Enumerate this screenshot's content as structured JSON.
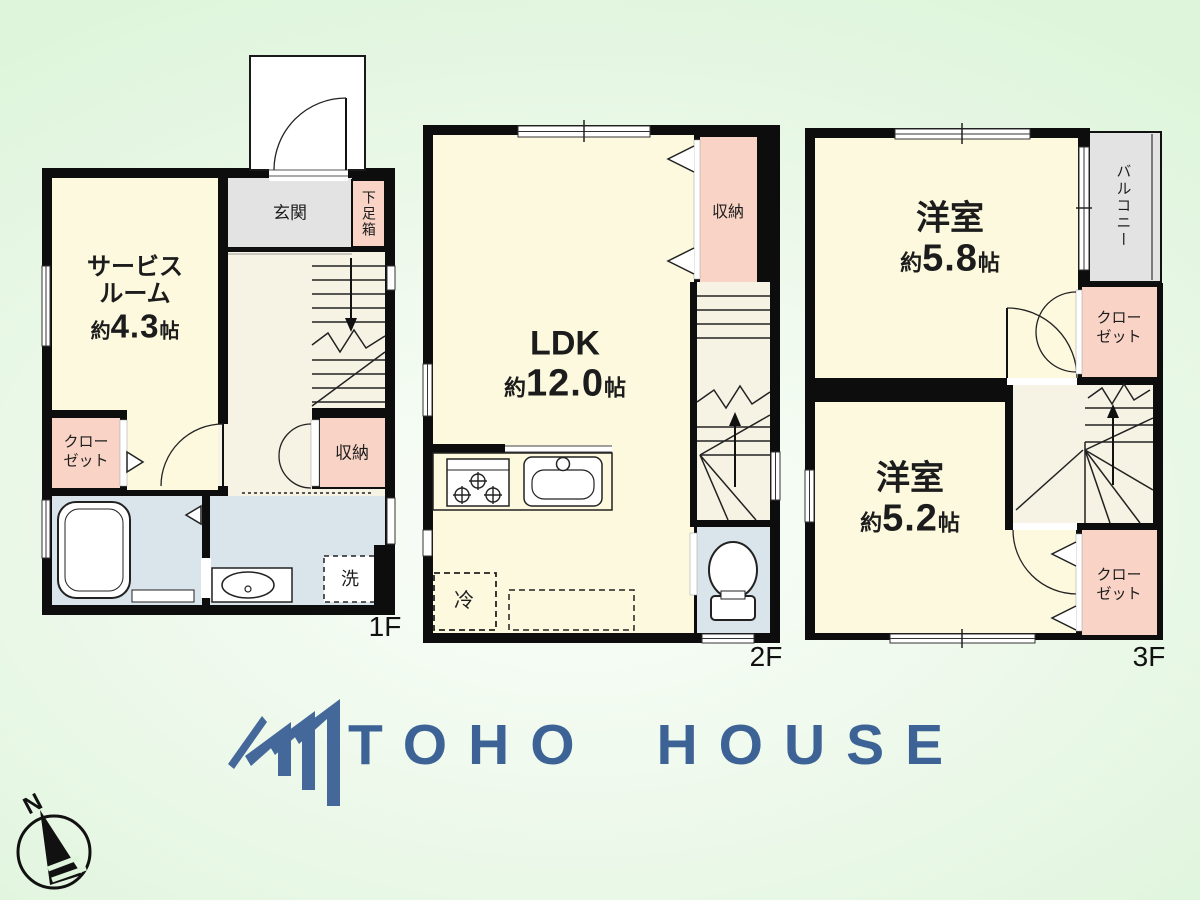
{
  "colors": {
    "accent_blue": "#3d6396",
    "room_cream": "#fcf9de",
    "room_pink": "#f9d4c6",
    "room_gray": "#e3e3e3",
    "room_blue": "#d9e5eb",
    "hall": "#f6f2e4",
    "bg_green": "#def5db"
  },
  "floors": {
    "f1": {
      "label": "1F",
      "rooms": {
        "service_room": {
          "line1": "サービス",
          "line2": "ルーム",
          "about": "約",
          "size": "4.3",
          "unit": "帖"
        },
        "entrance": "玄関",
        "shoe_box": "下足箱",
        "closet": {
          "line1": "クロー",
          "line2": "ゼット"
        },
        "storage": "収納",
        "laundry": "洗"
      }
    },
    "f2": {
      "label": "2F",
      "rooms": {
        "ldk": {
          "name": "LDK",
          "about": "約",
          "size": "12.0",
          "unit": "帖"
        },
        "storage": "収納",
        "fridge": "冷"
      }
    },
    "f3": {
      "label": "3F",
      "rooms": {
        "western_1": {
          "name": "洋室",
          "about": "約",
          "size": "5.8",
          "unit": "帖"
        },
        "western_2": {
          "name": "洋室",
          "about": "約",
          "size": "5.2",
          "unit": "帖"
        },
        "balcony": "バルコニー",
        "closet_upper": {
          "line1": "クロー",
          "line2": "ゼット"
        },
        "closet_lower": {
          "line1": "クロー",
          "line2": "ゼット"
        }
      }
    }
  },
  "logo": {
    "text": "TOHO HOUSE"
  },
  "compass": {
    "north": "N"
  }
}
